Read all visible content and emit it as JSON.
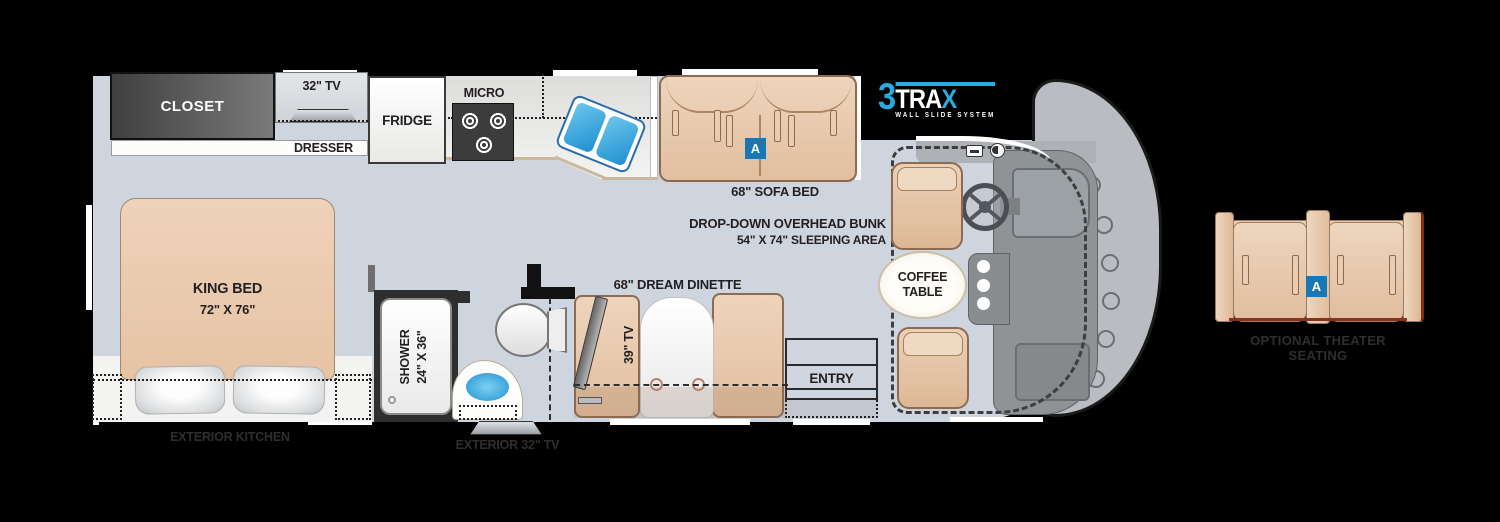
{
  "colors": {
    "floor": "#ced5df",
    "accent_blue": "#1778b5",
    "logo_blue": "#29abe2",
    "tan": "#e2c2a6",
    "sink_blue": "#3fa9dc"
  },
  "bedroom": {
    "closet": "CLOSET",
    "tv": "32\" TV",
    "dresser": "DRESSER",
    "bed_name": "KING BED",
    "bed_size": "72\" X 76\""
  },
  "galley": {
    "fridge": "FRIDGE",
    "micro": "MICRO"
  },
  "sofa": {
    "label": "68\" SOFA BED",
    "badge": "A"
  },
  "bunk": {
    "line1": "DROP-DOWN OVERHEAD BUNK",
    "line2": "54\" X 74\" SLEEPING AREA"
  },
  "bath": {
    "shower_name": "SHOWER",
    "shower_size": "24\" X 36\""
  },
  "dinette": {
    "label": "68\" DREAM DINETTE",
    "tv": "39\" TV"
  },
  "cab": {
    "coffee1": "COFFEE",
    "coffee2": "TABLE"
  },
  "entry": {
    "label": "ENTRY"
  },
  "exterior": {
    "kitchen": "EXTERIOR KITCHEN",
    "tv": "EXTERIOR 32\" TV"
  },
  "logo": {
    "n": "3",
    "tra": "TRA",
    "x": "X",
    "sub": "WALL SLIDE SYSTEM"
  },
  "theater": {
    "label": "OPTIONAL THEATER SEATING",
    "badge": "A"
  }
}
